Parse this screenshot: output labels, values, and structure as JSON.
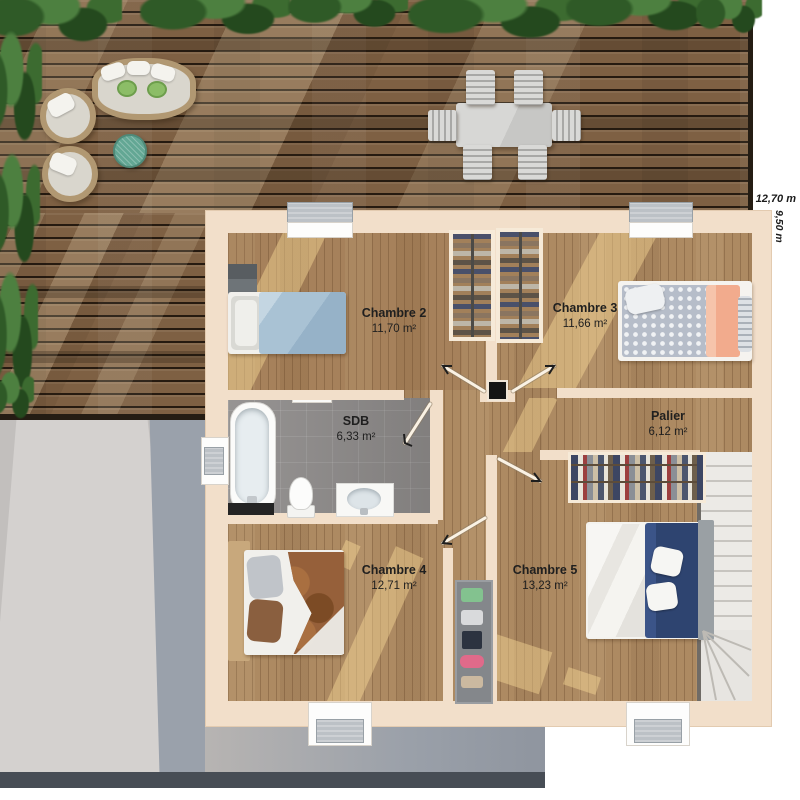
{
  "plan": {
    "title": "Plan d'étage - niveau chambres",
    "dimensions": {
      "width": "12,70 m",
      "depth": "9,50 m"
    },
    "rooms": [
      {
        "name": "Chambre 2",
        "area": "11,70 m²"
      },
      {
        "name": "Chambre 3",
        "area": "11,66 m²"
      },
      {
        "name": "SDB",
        "area": "6,33 m²"
      },
      {
        "name": "Palier",
        "area": "6,12 m²"
      },
      {
        "name": "Chambre 4",
        "area": "12,71 m²"
      },
      {
        "name": "Chambre 5",
        "area": "13,23 m²"
      }
    ],
    "features": [
      "terrace-wood-deck",
      "outdoor-dining-table-6-chairs",
      "daybed",
      "lounge-chairs",
      "side-table",
      "planters",
      "staircase",
      "bathtub",
      "toilet",
      "sink-vanity",
      "wardrobes",
      "open-closet-rail",
      "shelf-unit",
      "beds",
      "door-swings",
      "windows"
    ],
    "colors": {
      "wall": "#f2dfca",
      "wood_floor": "#ad8a62",
      "deck_wood": "#7e6043",
      "bath_tile": "#908d8c",
      "stairs": "#eceae6",
      "ground_concrete": "#c2bfbd",
      "ground_shadow": "#9aa1ab",
      "label_text": "#1f1f1f",
      "bed_blue": "#a9c2d4",
      "bed_navy": "#2e4470",
      "bed_peach": "#f4b79c",
      "bed_brown": "#96603a",
      "plant_green": "#3c6b30"
    }
  }
}
